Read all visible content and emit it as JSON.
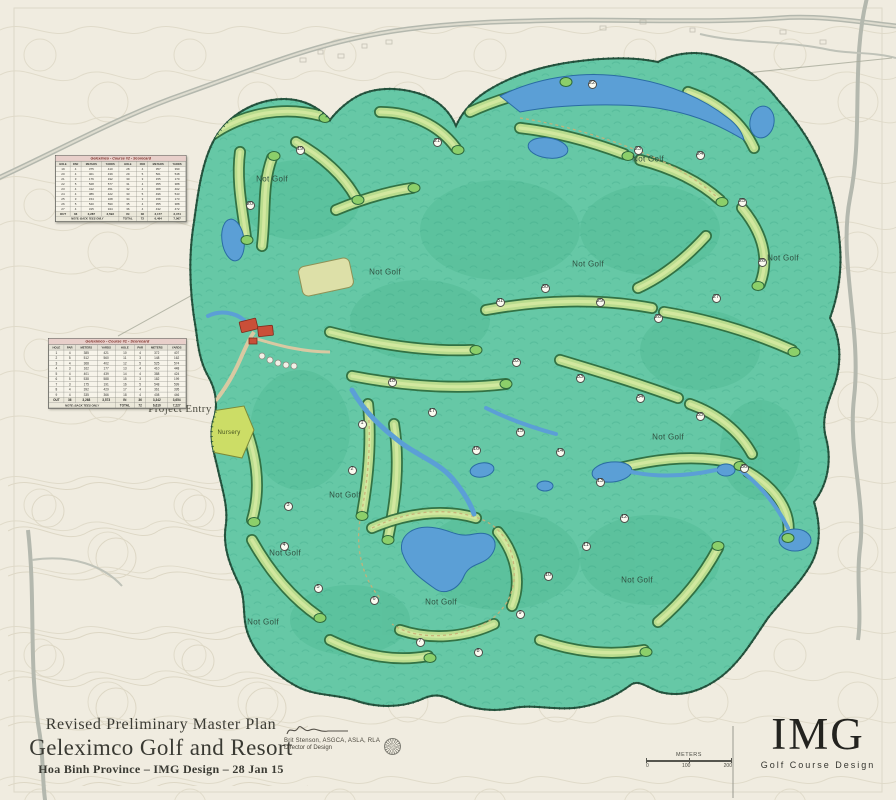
{
  "title_block": {
    "line1": "Revised Preliminary Master Plan",
    "line2": "Geleximco Golf and Resort",
    "line3": "Hoa Binh Province – IMG Design – 28 Jan 15"
  },
  "signature": {
    "name": "Brit Stenson, ASGCA, ASLA, RLA",
    "role": "Director of Design"
  },
  "logo": {
    "text": "IMG",
    "tagline": "Golf Course Design"
  },
  "scale_bar": {
    "label": "METERS",
    "ticks": [
      "0",
      "100",
      "200"
    ]
  },
  "colors": {
    "paper": "#f0ece0",
    "property_green": "#66c8a6",
    "fairway_green": "#b9dc8e",
    "tree_outline": "#2e6a3c",
    "water_blue": "#5b9fd6",
    "road_gray": "#b4b8ae",
    "clubhouse_red": "#c94f38",
    "scorecard_header": "#e8cfca",
    "scorecard_title_text": "#7c2c26"
  },
  "scorecards": [
    {
      "title": "Geleximco - Course #2 - Scorecard",
      "columns": [
        "HOLE",
        "PAR",
        "METERS",
        "YARDS",
        "HOLE",
        "PAR",
        "METERS",
        "YARDS"
      ],
      "rows": [
        [
          "19",
          "4",
          "375",
          "410",
          "28",
          "4",
          "357",
          "390"
        ],
        [
          "20",
          "4",
          "401",
          "439",
          "29",
          "5",
          "501",
          "548"
        ],
        [
          "21",
          "3",
          "176",
          "192",
          "30",
          "3",
          "155",
          "170"
        ],
        [
          "22",
          "5",
          "528",
          "577",
          "31",
          "4",
          "355",
          "388"
        ],
        [
          "23",
          "4",
          "412",
          "451",
          "32",
          "4",
          "368",
          "402"
        ],
        [
          "24",
          "4",
          "386",
          "422",
          "33",
          "5",
          "496",
          "543"
        ],
        [
          "25",
          "3",
          "154",
          "168",
          "34",
          "3",
          "158",
          "173"
        ],
        [
          "26",
          "5",
          "540",
          "590",
          "35",
          "4",
          "355",
          "388"
        ],
        [
          "27",
          "4",
          "315",
          "344",
          "36",
          "4",
          "432",
          "472"
        ]
      ],
      "summary_row": [
        "OUT",
        "36",
        "3,287",
        "3,593",
        "IN",
        "36",
        "3,177",
        "3,474"
      ],
      "total_row": [
        "TOTAL",
        "72",
        "6,464",
        "7,067"
      ],
      "note": "NOTE: BACK TEES ONLY"
    },
    {
      "title": "Geleximco - Course #1 - Scorecard",
      "columns": [
        "HOLE",
        "PAR",
        "METERS",
        "YARDS",
        "HOLE",
        "PAR",
        "METERS",
        "YARDS"
      ],
      "rows": [
        [
          "1",
          "4",
          "385",
          "421",
          "10",
          "4",
          "372",
          "407"
        ],
        [
          "2",
          "5",
          "512",
          "560",
          "11",
          "3",
          "148",
          "162"
        ],
        [
          "3",
          "4",
          "368",
          "402",
          "12",
          "5",
          "525",
          "574"
        ],
        [
          "4",
          "3",
          "162",
          "177",
          "13",
          "4",
          "410",
          "448"
        ],
        [
          "5",
          "4",
          "401",
          "439",
          "14",
          "4",
          "388",
          "424"
        ],
        [
          "6",
          "5",
          "538",
          "588",
          "15",
          "3",
          "182",
          "199"
        ],
        [
          "7",
          "3",
          "175",
          "191",
          "16",
          "5",
          "548",
          "599"
        ],
        [
          "8",
          "4",
          "392",
          "429",
          "17",
          "4",
          "361",
          "395"
        ],
        [
          "9",
          "4",
          "335",
          "366",
          "18",
          "4",
          "408",
          "446"
        ]
      ],
      "summary_row": [
        "OUT",
        "36",
        "3,268",
        "3,573",
        "IN",
        "36",
        "3,342",
        "3,654"
      ],
      "total_row": [
        "TOTAL",
        "72",
        "6,610",
        "7,227"
      ],
      "note": "NOTE: BACK TEES ONLY"
    }
  ],
  "map_labels": [
    {
      "kind": "not-golf",
      "text": "Not Golf",
      "x": 272,
      "y": 179
    },
    {
      "kind": "not-golf",
      "text": "Not Golf",
      "x": 385,
      "y": 272
    },
    {
      "kind": "not-golf",
      "text": "Not Golf",
      "x": 588,
      "y": 264
    },
    {
      "kind": "not-golf",
      "text": "Not Golf",
      "x": 648,
      "y": 159
    },
    {
      "kind": "not-golf",
      "text": "Not Golf",
      "x": 783,
      "y": 258
    },
    {
      "kind": "not-golf",
      "text": "Not Golf",
      "x": 345,
      "y": 495
    },
    {
      "kind": "not-golf",
      "text": "Not Golf",
      "x": 285,
      "y": 553
    },
    {
      "kind": "not-golf",
      "text": "Not Golf",
      "x": 441,
      "y": 602
    },
    {
      "kind": "not-golf",
      "text": "Not Golf",
      "x": 637,
      "y": 580
    },
    {
      "kind": "not-golf",
      "text": "Not Golf",
      "x": 263,
      "y": 622
    },
    {
      "kind": "not-golf",
      "text": "Not Golf",
      "x": 668,
      "y": 437
    },
    {
      "kind": "entry",
      "text": "Project Entry",
      "x": 180,
      "y": 409
    },
    {
      "kind": "nursery",
      "text": "Nursery",
      "x": 229,
      "y": 433
    }
  ],
  "hole_markers": [
    {
      "n": "1",
      "x": 362,
      "y": 424
    },
    {
      "n": "2",
      "x": 352,
      "y": 470
    },
    {
      "n": "3",
      "x": 288,
      "y": 506
    },
    {
      "n": "4",
      "x": 284,
      "y": 546
    },
    {
      "n": "5",
      "x": 318,
      "y": 588
    },
    {
      "n": "6",
      "x": 374,
      "y": 600
    },
    {
      "n": "7",
      "x": 420,
      "y": 642
    },
    {
      "n": "8",
      "x": 478,
      "y": 652
    },
    {
      "n": "9",
      "x": 520,
      "y": 614
    },
    {
      "n": "10",
      "x": 548,
      "y": 576
    },
    {
      "n": "11",
      "x": 586,
      "y": 546
    },
    {
      "n": "12",
      "x": 624,
      "y": 518
    },
    {
      "n": "13",
      "x": 600,
      "y": 482
    },
    {
      "n": "14",
      "x": 560,
      "y": 452
    },
    {
      "n": "15",
      "x": 520,
      "y": 432
    },
    {
      "n": "16",
      "x": 476,
      "y": 450
    },
    {
      "n": "17",
      "x": 432,
      "y": 412
    },
    {
      "n": "18",
      "x": 392,
      "y": 382
    },
    {
      "n": "19",
      "x": 300,
      "y": 150
    },
    {
      "n": "20",
      "x": 250,
      "y": 205
    },
    {
      "n": "21",
      "x": 437,
      "y": 142
    },
    {
      "n": "22",
      "x": 592,
      "y": 84
    },
    {
      "n": "23",
      "x": 638,
      "y": 150
    },
    {
      "n": "24",
      "x": 700,
      "y": 155
    },
    {
      "n": "25",
      "x": 742,
      "y": 202
    },
    {
      "n": "26",
      "x": 762,
      "y": 262
    },
    {
      "n": "27",
      "x": 716,
      "y": 298
    },
    {
      "n": "28",
      "x": 658,
      "y": 318
    },
    {
      "n": "29",
      "x": 600,
      "y": 302
    },
    {
      "n": "30",
      "x": 545,
      "y": 288
    },
    {
      "n": "31",
      "x": 500,
      "y": 302
    },
    {
      "n": "32",
      "x": 516,
      "y": 362
    },
    {
      "n": "33",
      "x": 580,
      "y": 378
    },
    {
      "n": "34",
      "x": 640,
      "y": 398
    },
    {
      "n": "35",
      "x": 700,
      "y": 416
    },
    {
      "n": "36",
      "x": 744,
      "y": 468
    }
  ]
}
